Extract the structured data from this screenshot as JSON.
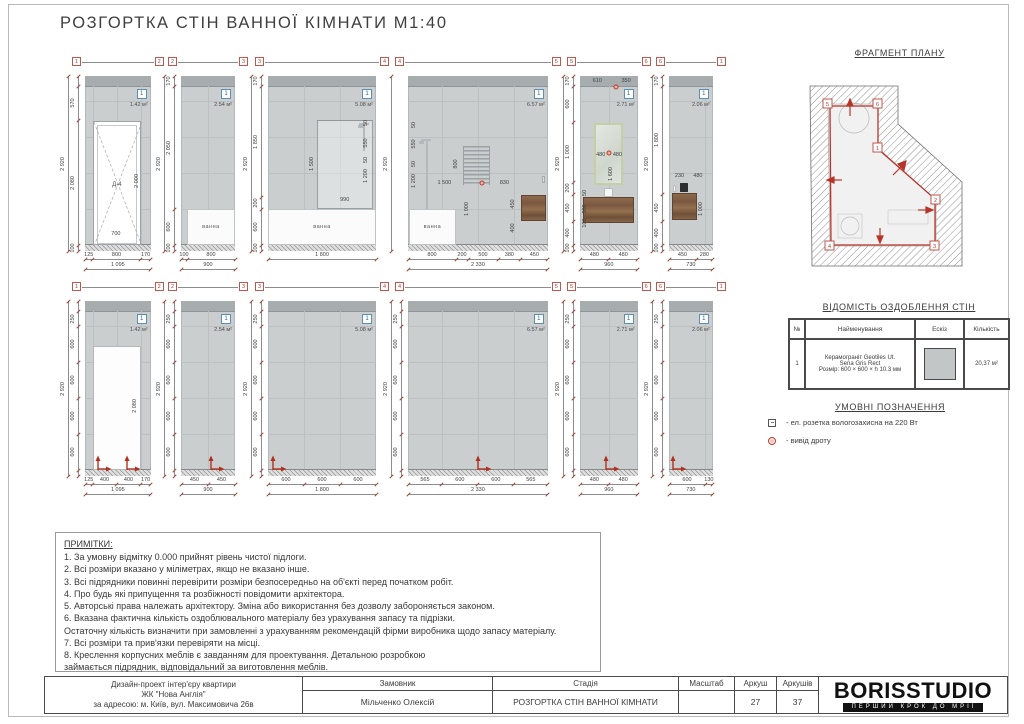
{
  "sheet_title": "РОЗГОРТКА СТІН ВАННОЇ КІМНАТИ М1:40",
  "fragment_plan": {
    "title": "ФРАГМЕНТ ПЛАНУ",
    "markers": [
      {
        "n": "5",
        "x": 31,
        "y": 39
      },
      {
        "n": "6",
        "x": 81,
        "y": 39
      },
      {
        "n": "1",
        "x": 81,
        "y": 83
      },
      {
        "n": "2",
        "x": 139,
        "y": 135
      },
      {
        "n": "3",
        "x": 138,
        "y": 181
      },
      {
        "n": "4",
        "x": 33,
        "y": 181
      }
    ]
  },
  "finish_table": {
    "title": "ВІДОМІСТЬ ОЗДОБЛЕННЯ СТІН",
    "headers": [
      "№",
      "Найменування",
      "Ескіз",
      "Кількість"
    ],
    "row": {
      "num": "1",
      "name_lines": [
        "Керамограніт Geotiles Ut.",
        "Sena Gris Rect",
        "Розмір: 600 × 600 × h 10.3 мм"
      ],
      "qty": "20,37 м²"
    }
  },
  "legend": {
    "title": "УМОВНІ ПОЗНАЧЕННЯ",
    "items": [
      {
        "icon": "socket-icon",
        "text": "- ел. розетка вологозахисна на 220 Вт"
      },
      {
        "icon": "wire-outlet-icon",
        "text": "- вивід дроту"
      }
    ]
  },
  "notes": {
    "title": "ПРИМІТКИ:",
    "lines": [
      "1. За умовну відмітку 0.000 прийнят рівень чистої підлоги.",
      "2. Всі розміри вказано у міліметрах, якщо не вказано інше.",
      "3. Всі підрядники повинні перевірити розміри безпосередньо на об'єкті перед початком робіт.",
      "4. Про будь які припущення та розбіжності повідомити архітектора.",
      "5. Авторські права належать архітектору. Зміна або використання без дозволу забороняється законом.",
      "6. Вказана фактична кількість оздоблювального матеріалу без урахування запасу та підрізки.",
      "Остаточну кількість визначити при замовленні з урахуванням рекомендацій фірми виробника щодо запасу матеріалу.",
      "7. Всі розміри та прив'язки перевіряти на місці.",
      "8. Креслення корпусних меблів є завданням для проектування. Детальною розробкою",
      "займається підрядник, відповідальний за виготовлення меблів."
    ]
  },
  "title_block": {
    "project_lines": [
      "Дизайн-проект інтер'єру квартири",
      "ЖК \"Нова Англія\"",
      "за адресою: м. Київ, вул. Максимовича 26в"
    ],
    "client_label": "Замовник",
    "client": "Мільченко Олексій",
    "stage_label": "Стадія",
    "stage": "РОЗГОРТКА СТІН ВАННОЇ КІМНАТИ",
    "scale_label": "Масштаб",
    "scale": "",
    "sheet_label": "Аркуш",
    "sheet": "27",
    "sheets_label": "Аркушів",
    "sheets": "37",
    "logo": "BORISSTUDIO",
    "slogan": "ПЕРШИЙ КРОК ДО МРІЇ"
  },
  "elevations_top": [
    {
      "markers": [
        "1",
        "2"
      ],
      "badge": "1",
      "area": "1.42 м²",
      "height_total": "2 920",
      "left_dims": [
        {
          "v": "",
          "mm": 170
        },
        {
          "v": "570"
        },
        {
          "v": "2 080"
        },
        {
          "v": "100"
        }
      ],
      "bottom_dims": [
        {
          "v": "125"
        },
        {
          "v": "800"
        },
        {
          "v": "170"
        }
      ],
      "bottom_total": "1 095",
      "fixtures": [
        {
          "k": "door",
          "x": 12,
          "y": 25.5,
          "w": 73,
          "h": 71,
          "label": "Д-4"
        }
      ],
      "dims": [
        {
          "t": "2 000",
          "x": 79,
          "y": 60,
          "r": 1
        },
        {
          "t": "700",
          "x": 47,
          "y": 90
        }
      ]
    },
    {
      "markers": [
        "2",
        "3"
      ],
      "badge": "1",
      "area": "2.54 м²",
      "height_total": "2 920",
      "left_dims": [
        {
          "v": "170"
        },
        {
          "v": "2 050"
        },
        {
          "v": "600"
        },
        {
          "v": "100"
        }
      ],
      "bottom_dims": [
        {
          "v": "100"
        },
        {
          "v": "800"
        }
      ],
      "bottom_total": "900",
      "fixtures": [
        {
          "k": "tub",
          "x": 11,
          "y": 76,
          "w": 89,
          "h": 20.5,
          "label": "ванна"
        }
      ],
      "dims": []
    },
    {
      "markers": [
        "3",
        "4"
      ],
      "badge": "1",
      "area": "5.08 м²",
      "height_total": "2 920",
      "left_dims": [
        {
          "v": "170"
        },
        {
          "v": "1 850"
        },
        {
          "v": "200"
        },
        {
          "v": "600"
        },
        {
          "v": "100"
        }
      ],
      "bottom_dims": [
        {
          "v": "1 800"
        }
      ],
      "bottom_total": "",
      "fixtures": [
        {
          "k": "tub",
          "x": 0,
          "y": 76,
          "w": 100,
          "h": 20.5,
          "label": "ванна"
        },
        {
          "k": "glass",
          "x": 45,
          "y": 25,
          "w": 52,
          "h": 51
        },
        {
          "k": "shower",
          "x": 88,
          "y": 27,
          "h": 16
        }
      ],
      "dims": [
        {
          "t": "1 500",
          "x": 41,
          "y": 50,
          "r": 1
        },
        {
          "t": "990",
          "x": 71,
          "y": 71
        },
        {
          "t": "1 200",
          "x": 91,
          "y": 57,
          "r": 1
        },
        {
          "t": "550",
          "x": 91,
          "y": 38,
          "r": 1
        },
        {
          "t": "50",
          "x": 91,
          "y": 27,
          "r": 1
        },
        {
          "t": "50",
          "x": 91,
          "y": 48,
          "r": 1
        }
      ]
    },
    {
      "markers": [
        "4",
        "5"
      ],
      "badge": "1",
      "area": "6.57 м²",
      "height_total": "2 920",
      "left_dims": [],
      "bottom_dims": [
        {
          "v": "800"
        },
        {
          "v": "200"
        },
        {
          "v": "500"
        },
        {
          "v": "380"
        },
        {
          "v": "450"
        }
      ],
      "bottom_total": "2 330",
      "fixtures": [
        {
          "k": "tub",
          "x": 1,
          "y": 76,
          "w": 33,
          "h": 20.5,
          "label": "ванна"
        },
        {
          "k": "shower",
          "x": 13,
          "y": 36,
          "h": 40
        },
        {
          "k": "rail",
          "x": 39,
          "y": 40,
          "w": 20,
          "h": 22
        },
        {
          "k": "wood",
          "x": 81,
          "y": 68,
          "w": 18,
          "h": 15
        },
        {
          "k": "dot",
          "x": 53,
          "y": 61
        },
        {
          "k": "faucet",
          "x": 96,
          "y": 57
        }
      ],
      "dims": [
        {
          "t": "800",
          "x": 34,
          "y": 50,
          "r": 1
        },
        {
          "t": "1 500",
          "x": 26,
          "y": 61
        },
        {
          "t": "830",
          "x": 69,
          "y": 61
        },
        {
          "t": "1 000",
          "x": 42,
          "y": 76,
          "r": 1
        },
        {
          "t": "450",
          "x": 75,
          "y": 73,
          "r": 1
        },
        {
          "t": "400",
          "x": 75,
          "y": 87,
          "r": 1
        },
        {
          "t": "1 200",
          "x": 4,
          "y": 60,
          "r": 1
        },
        {
          "t": "550",
          "x": 4,
          "y": 39,
          "r": 1
        },
        {
          "t": "50",
          "x": 4,
          "y": 28,
          "r": 1
        },
        {
          "t": "50",
          "x": 4,
          "y": 50,
          "r": 1
        }
      ]
    },
    {
      "markers": [
        "5",
        "6"
      ],
      "badge": "1",
      "area": "2.71 м²",
      "height_total": "2 920",
      "left_dims": [
        {
          "v": "170"
        },
        {
          "v": "600"
        },
        {
          "v": "1 000"
        },
        {
          "v": "200"
        },
        {
          "v": "450"
        },
        {
          "v": "400"
        },
        {
          "v": "100"
        }
      ],
      "bottom_dims": [
        {
          "v": "480"
        },
        {
          "v": "480"
        }
      ],
      "bottom_total": "960",
      "fixtures": [
        {
          "k": "mirror",
          "x": 25,
          "y": 27,
          "w": 50,
          "h": 35
        },
        {
          "k": "wood",
          "x": 6,
          "y": 69,
          "w": 88,
          "h": 15
        },
        {
          "k": "sink",
          "x": 41,
          "y": 64,
          "w": 16,
          "h": 5
        },
        {
          "k": "dot",
          "x": 62,
          "y": 6
        },
        {
          "k": "dot",
          "x": 50,
          "y": 44
        }
      ],
      "dims": [
        {
          "t": "610",
          "x": 30,
          "y": 3
        },
        {
          "t": "350",
          "x": 80,
          "y": 3
        },
        {
          "t": "480",
          "x": 36,
          "y": 45
        },
        {
          "t": "480",
          "x": 65,
          "y": 45
        },
        {
          "t": "1 600",
          "x": 53,
          "y": 56,
          "r": 1
        },
        {
          "t": "50",
          "x": 9,
          "y": 67,
          "r": 1
        },
        {
          "t": "300",
          "x": 9,
          "y": 76,
          "r": 1
        },
        {
          "t": "100",
          "x": 9,
          "y": 84,
          "r": 1
        }
      ]
    },
    {
      "markers": [
        "6",
        "1"
      ],
      "badge": "1",
      "area": "2.06 м²",
      "height_total": "2 920",
      "left_dims": [
        {
          "v": "170"
        },
        {
          "v": "1 800"
        },
        {
          "v": "450"
        },
        {
          "v": "400"
        },
        {
          "v": "100"
        }
      ],
      "bottom_dims": [
        {
          "v": "450"
        },
        {
          "v": "280"
        }
      ],
      "bottom_total": "730",
      "fixtures": [
        {
          "k": "wood",
          "x": 7,
          "y": 67,
          "w": 56,
          "h": 15
        },
        {
          "k": "device",
          "x": 24,
          "y": 61,
          "w": 20,
          "h": 5
        },
        {
          "k": "sink",
          "x": 10,
          "y": 62,
          "w": 7,
          "h": 4
        }
      ],
      "dims": [
        {
          "t": "230",
          "x": 24,
          "y": 57
        },
        {
          "t": "480",
          "x": 66,
          "y": 57
        },
        {
          "t": "1 000",
          "x": 74,
          "y": 76,
          "r": 1
        }
      ]
    }
  ],
  "elevations_bottom": [
    {
      "markers": [
        "1",
        "2"
      ],
      "badge": "1",
      "area": "1.42 м²",
      "height_total": "2 920",
      "left_dims": [
        {
          "v": "",
          "mm": 170
        },
        {
          "v": "250"
        },
        {
          "v": "600"
        },
        {
          "v": "600"
        },
        {
          "v": "600"
        },
        {
          "v": "600"
        },
        {
          "v": "",
          "mm": 100
        }
      ],
      "bottom_dims": [
        {
          "v": "125"
        },
        {
          "v": "400"
        },
        {
          "v": "400"
        },
        {
          "v": "170"
        }
      ],
      "bottom_total": "1 095",
      "fixtures": [
        {
          "k": "open",
          "x": 12,
          "y": 25.5,
          "w": 73,
          "h": 71
        },
        {
          "k": "axis",
          "x": 20
        },
        {
          "k": "axis",
          "x": 64
        }
      ],
      "dims": [
        {
          "t": "2 080",
          "x": 76,
          "y": 60,
          "r": 1
        }
      ]
    },
    {
      "markers": [
        "2",
        "3"
      ],
      "badge": "1",
      "area": "2.54 м²",
      "height_total": "2 920",
      "left_dims": [
        {
          "v": "",
          "mm": 170
        },
        {
          "v": "250"
        },
        {
          "v": "600"
        },
        {
          "v": "600"
        },
        {
          "v": "600"
        },
        {
          "v": "600"
        },
        {
          "v": "",
          "mm": 100
        }
      ],
      "bottom_dims": [
        {
          "v": "450"
        },
        {
          "v": "450"
        }
      ],
      "bottom_total": "900",
      "fixtures": [
        {
          "k": "axis",
          "x": 55
        }
      ],
      "dims": []
    },
    {
      "markers": [
        "3",
        "4"
      ],
      "badge": "1",
      "area": "5.08 м²",
      "height_total": "2 920",
      "left_dims": [
        {
          "v": "",
          "mm": 170
        },
        {
          "v": "250"
        },
        {
          "v": "600"
        },
        {
          "v": "600"
        },
        {
          "v": "600"
        },
        {
          "v": "600"
        },
        {
          "v": "",
          "mm": 100
        }
      ],
      "bottom_dims": [
        {
          "v": "600"
        },
        {
          "v": "600"
        },
        {
          "v": "600"
        }
      ],
      "bottom_total": "1 800",
      "fixtures": [
        {
          "k": "axis",
          "x": 5
        }
      ],
      "dims": []
    },
    {
      "markers": [
        "4",
        "5"
      ],
      "badge": "1",
      "area": "6.57 м²",
      "height_total": "2 920",
      "left_dims": [
        {
          "v": "",
          "mm": 170
        },
        {
          "v": "250"
        },
        {
          "v": "600"
        },
        {
          "v": "600"
        },
        {
          "v": "600"
        },
        {
          "v": "600"
        },
        {
          "v": "",
          "mm": 100
        }
      ],
      "bottom_dims": [
        {
          "v": "565"
        },
        {
          "v": "600"
        },
        {
          "v": "600"
        },
        {
          "v": "565"
        }
      ],
      "bottom_total": "2 330",
      "fixtures": [
        {
          "k": "axis",
          "x": 50
        }
      ],
      "dims": []
    },
    {
      "markers": [
        "5",
        "6"
      ],
      "badge": "1",
      "area": "2.71 м²",
      "height_total": "2 920",
      "left_dims": [
        {
          "v": "",
          "mm": 170
        },
        {
          "v": "250"
        },
        {
          "v": "600"
        },
        {
          "v": "600"
        },
        {
          "v": "600"
        },
        {
          "v": "600"
        },
        {
          "v": "",
          "mm": 100
        }
      ],
      "bottom_dims": [
        {
          "v": "480"
        },
        {
          "v": "480"
        }
      ],
      "bottom_total": "960",
      "fixtures": [
        {
          "k": "axis",
          "x": 45
        }
      ],
      "dims": []
    },
    {
      "markers": [
        "6",
        "1"
      ],
      "badge": "1",
      "area": "2.06 м²",
      "height_total": "2 920",
      "left_dims": [
        {
          "v": "",
          "mm": 170
        },
        {
          "v": "250"
        },
        {
          "v": "600"
        },
        {
          "v": "600"
        },
        {
          "v": "600"
        },
        {
          "v": "600"
        },
        {
          "v": "",
          "mm": 100
        }
      ],
      "bottom_dims": [
        {
          "v": "600"
        },
        {
          "v": "130"
        }
      ],
      "bottom_total": "730",
      "fixtures": [
        {
          "k": "axis",
          "x": 8
        }
      ],
      "dims": []
    }
  ]
}
